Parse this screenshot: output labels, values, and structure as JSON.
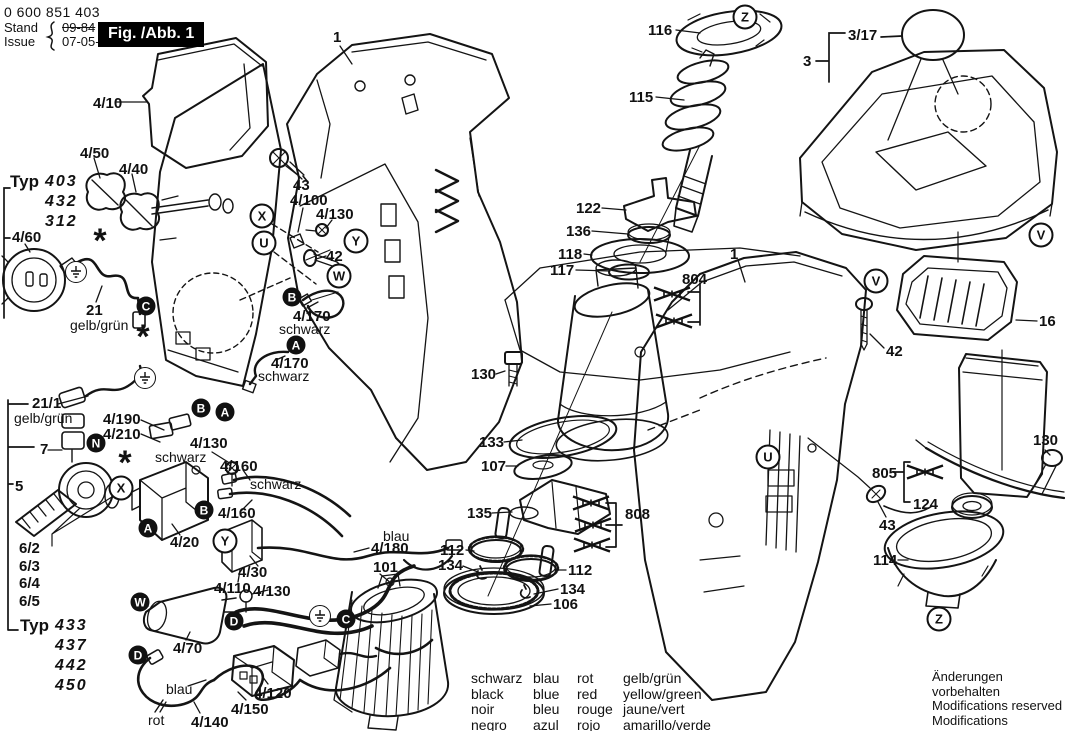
{
  "header": {
    "part_number": "0 600 851 403",
    "stand_label": "Stand",
    "issue_label": "Issue",
    "old_date": "09-84",
    "date": "07-05-15",
    "figure_label": "Fig. /Abb. 1"
  },
  "typ_groups": [
    {
      "word": "Typ",
      "models": [
        "403",
        "432",
        "312"
      ],
      "x": 10,
      "y": 172
    },
    {
      "word": "Typ",
      "models": [
        "433",
        "437",
        "442",
        "450"
      ],
      "x": 20,
      "y": 616
    }
  ],
  "part_labels": [
    {
      "text": "4/10",
      "x": 93,
      "y": 96
    },
    {
      "text": "4/50",
      "x": 80,
      "y": 146
    },
    {
      "text": "4/40",
      "x": 119,
      "y": 162
    },
    {
      "text": "4/60",
      "x": 12,
      "y": 230
    },
    {
      "text": "21",
      "x": 86,
      "y": 303
    },
    {
      "text": "gelb/grün",
      "x": 70,
      "y": 318,
      "style": "color"
    },
    {
      "text": "21/1",
      "x": 32,
      "y": 396
    },
    {
      "text": "gelb/grün",
      "x": 14,
      "y": 411,
      "style": "color"
    },
    {
      "text": "4/190",
      "x": 103,
      "y": 412
    },
    {
      "text": "4/210",
      "x": 103,
      "y": 427
    },
    {
      "text": "7",
      "x": 40,
      "y": 442
    },
    {
      "text": "schwarz",
      "x": 155,
      "y": 450,
      "style": "color"
    },
    {
      "text": "4/130",
      "x": 190,
      "y": 436
    },
    {
      "text": "5",
      "x": 15,
      "y": 479
    },
    {
      "text": "4/160",
      "x": 220,
      "y": 459
    },
    {
      "text": "schwarz",
      "x": 250,
      "y": 477,
      "style": "color"
    },
    {
      "text": "4/160",
      "x": 218,
      "y": 506
    },
    {
      "text": "6/2",
      "x": 19,
      "y": 541
    },
    {
      "text": "6/3",
      "x": 19,
      "y": 559
    },
    {
      "text": "6/4",
      "x": 19,
      "y": 576
    },
    {
      "text": "6/5",
      "x": 19,
      "y": 594
    },
    {
      "text": "4/20",
      "x": 170,
      "y": 535
    },
    {
      "text": "4/30",
      "x": 238,
      "y": 565
    },
    {
      "text": "4/110",
      "x": 214,
      "y": 581
    },
    {
      "text": "4/130",
      "x": 253,
      "y": 584
    },
    {
      "text": "4/70",
      "x": 173,
      "y": 641
    },
    {
      "text": "blau",
      "x": 166,
      "y": 682,
      "style": "color"
    },
    {
      "text": "rot",
      "x": 148,
      "y": 713,
      "style": "color"
    },
    {
      "text": "4/140",
      "x": 191,
      "y": 715
    },
    {
      "text": "4/150",
      "x": 231,
      "y": 702
    },
    {
      "text": "4/120",
      "x": 254,
      "y": 686
    },
    {
      "text": "blau",
      "x": 383,
      "y": 529,
      "style": "color"
    },
    {
      "text": "4/180",
      "x": 371,
      "y": 541
    },
    {
      "text": "101",
      "x": 373,
      "y": 560
    },
    {
      "text": "43",
      "x": 293,
      "y": 178
    },
    {
      "text": "4/100",
      "x": 290,
      "y": 193
    },
    {
      "text": "4/130",
      "x": 316,
      "y": 207
    },
    {
      "text": "42",
      "x": 326,
      "y": 249
    },
    {
      "text": "4/170",
      "x": 293,
      "y": 309
    },
    {
      "text": "schwarz",
      "x": 279,
      "y": 322,
      "style": "color"
    },
    {
      "text": "4/170",
      "x": 271,
      "y": 356
    },
    {
      "text": "schwarz",
      "x": 258,
      "y": 369,
      "style": "color"
    },
    {
      "text": "1",
      "x": 333,
      "y": 30
    },
    {
      "text": "116",
      "x": 648,
      "y": 23
    },
    {
      "text": "115",
      "x": 629,
      "y": 90
    },
    {
      "text": "122",
      "x": 576,
      "y": 201
    },
    {
      "text": "136",
      "x": 566,
      "y": 224
    },
    {
      "text": "118",
      "x": 558,
      "y": 247
    },
    {
      "text": "117",
      "x": 550,
      "y": 263
    },
    {
      "text": "804",
      "x": 682,
      "y": 272
    },
    {
      "text": "3/17",
      "x": 848,
      "y": 28
    },
    {
      "text": "3",
      "x": 803,
      "y": 54
    },
    {
      "text": "1",
      "x": 730,
      "y": 247
    },
    {
      "text": "42",
      "x": 886,
      "y": 344
    },
    {
      "text": "16",
      "x": 1039,
      "y": 314
    },
    {
      "text": "130",
      "x": 471,
      "y": 367
    },
    {
      "text": "133",
      "x": 479,
      "y": 435
    },
    {
      "text": "107",
      "x": 481,
      "y": 459
    },
    {
      "text": "135",
      "x": 467,
      "y": 506
    },
    {
      "text": "112",
      "x": 440,
      "y": 543
    },
    {
      "text": "134",
      "x": 438,
      "y": 558
    },
    {
      "text": "112",
      "x": 568,
      "y": 563
    },
    {
      "text": "134",
      "x": 560,
      "y": 582
    },
    {
      "text": "106",
      "x": 553,
      "y": 597
    },
    {
      "text": "808",
      "x": 625,
      "y": 507
    },
    {
      "text": "130",
      "x": 1033,
      "y": 433
    },
    {
      "text": "805",
      "x": 872,
      "y": 466
    },
    {
      "text": "124",
      "x": 913,
      "y": 497
    },
    {
      "text": "43",
      "x": 879,
      "y": 518
    },
    {
      "text": "114",
      "x": 873,
      "y": 553
    }
  ],
  "badges": [
    {
      "letter": "X",
      "x": 262,
      "y": 216,
      "type": "outlined"
    },
    {
      "letter": "U",
      "x": 264,
      "y": 243,
      "type": "outlined"
    },
    {
      "letter": "Y",
      "x": 356,
      "y": 241,
      "type": "outlined"
    },
    {
      "letter": "W",
      "x": 339,
      "y": 276,
      "type": "outlined"
    },
    {
      "letter": "X",
      "x": 121,
      "y": 488,
      "type": "outlined"
    },
    {
      "letter": "Y",
      "x": 225,
      "y": 541,
      "type": "outlined"
    },
    {
      "letter": "U",
      "x": 768,
      "y": 457,
      "type": "outlined"
    },
    {
      "letter": "V",
      "x": 876,
      "y": 281,
      "type": "outlined"
    },
    {
      "letter": "V",
      "x": 1041,
      "y": 235,
      "type": "outlined"
    },
    {
      "letter": "Z",
      "x": 745,
      "y": 17,
      "type": "outlined"
    },
    {
      "letter": "Z",
      "x": 939,
      "y": 619,
      "type": "outlined"
    },
    {
      "letter": "C",
      "x": 146,
      "y": 306,
      "type": "filled"
    },
    {
      "letter": "B",
      "x": 201,
      "y": 408,
      "type": "filled"
    },
    {
      "letter": "A",
      "x": 225,
      "y": 412,
      "type": "filled"
    },
    {
      "letter": "N",
      "x": 96,
      "y": 443,
      "type": "filled"
    },
    {
      "letter": "B",
      "x": 204,
      "y": 510,
      "type": "filled"
    },
    {
      "letter": "A",
      "x": 148,
      "y": 528,
      "type": "filled"
    },
    {
      "letter": "B",
      "x": 292,
      "y": 297,
      "type": "filled"
    },
    {
      "letter": "A",
      "x": 296,
      "y": 345,
      "type": "filled"
    },
    {
      "letter": "W",
      "x": 140,
      "y": 602,
      "type": "filled"
    },
    {
      "letter": "D",
      "x": 234,
      "y": 621,
      "type": "filled"
    },
    {
      "letter": "D",
      "x": 138,
      "y": 655,
      "type": "filled"
    },
    {
      "letter": "C",
      "x": 346,
      "y": 619,
      "type": "filled"
    }
  ],
  "ground_symbols": [
    {
      "x": 76,
      "y": 272
    },
    {
      "x": 145,
      "y": 378
    },
    {
      "x": 320,
      "y": 616
    }
  ],
  "asterisks": [
    {
      "x": 100,
      "y": 238
    },
    {
      "x": 143,
      "y": 334
    },
    {
      "x": 125,
      "y": 460
    }
  ],
  "struck_items": [
    {
      "x": 672,
      "y": 294,
      "group": "804"
    },
    {
      "x": 674,
      "y": 321,
      "group": "804"
    },
    {
      "x": 591,
      "y": 503,
      "group": "808"
    },
    {
      "x": 593,
      "y": 525,
      "group": "808"
    },
    {
      "x": 592,
      "y": 545,
      "group": "808"
    },
    {
      "x": 925,
      "y": 472,
      "group": "805"
    }
  ],
  "legend": {
    "rows": [
      [
        "schwarz",
        "blau",
        "rot",
        "gelb/grün"
      ],
      [
        "black",
        "blue",
        "red",
        "yellow/green"
      ],
      [
        "noir",
        "bleu",
        "rouge",
        "jaune/vert"
      ],
      [
        "negro",
        "azul",
        "rojo",
        "amarillo/verde"
      ]
    ]
  },
  "notices": [
    "Änderungen vorbehalten",
    "Modifications reserved",
    "Modifications reservees",
    "Salvo modificaciones"
  ]
}
